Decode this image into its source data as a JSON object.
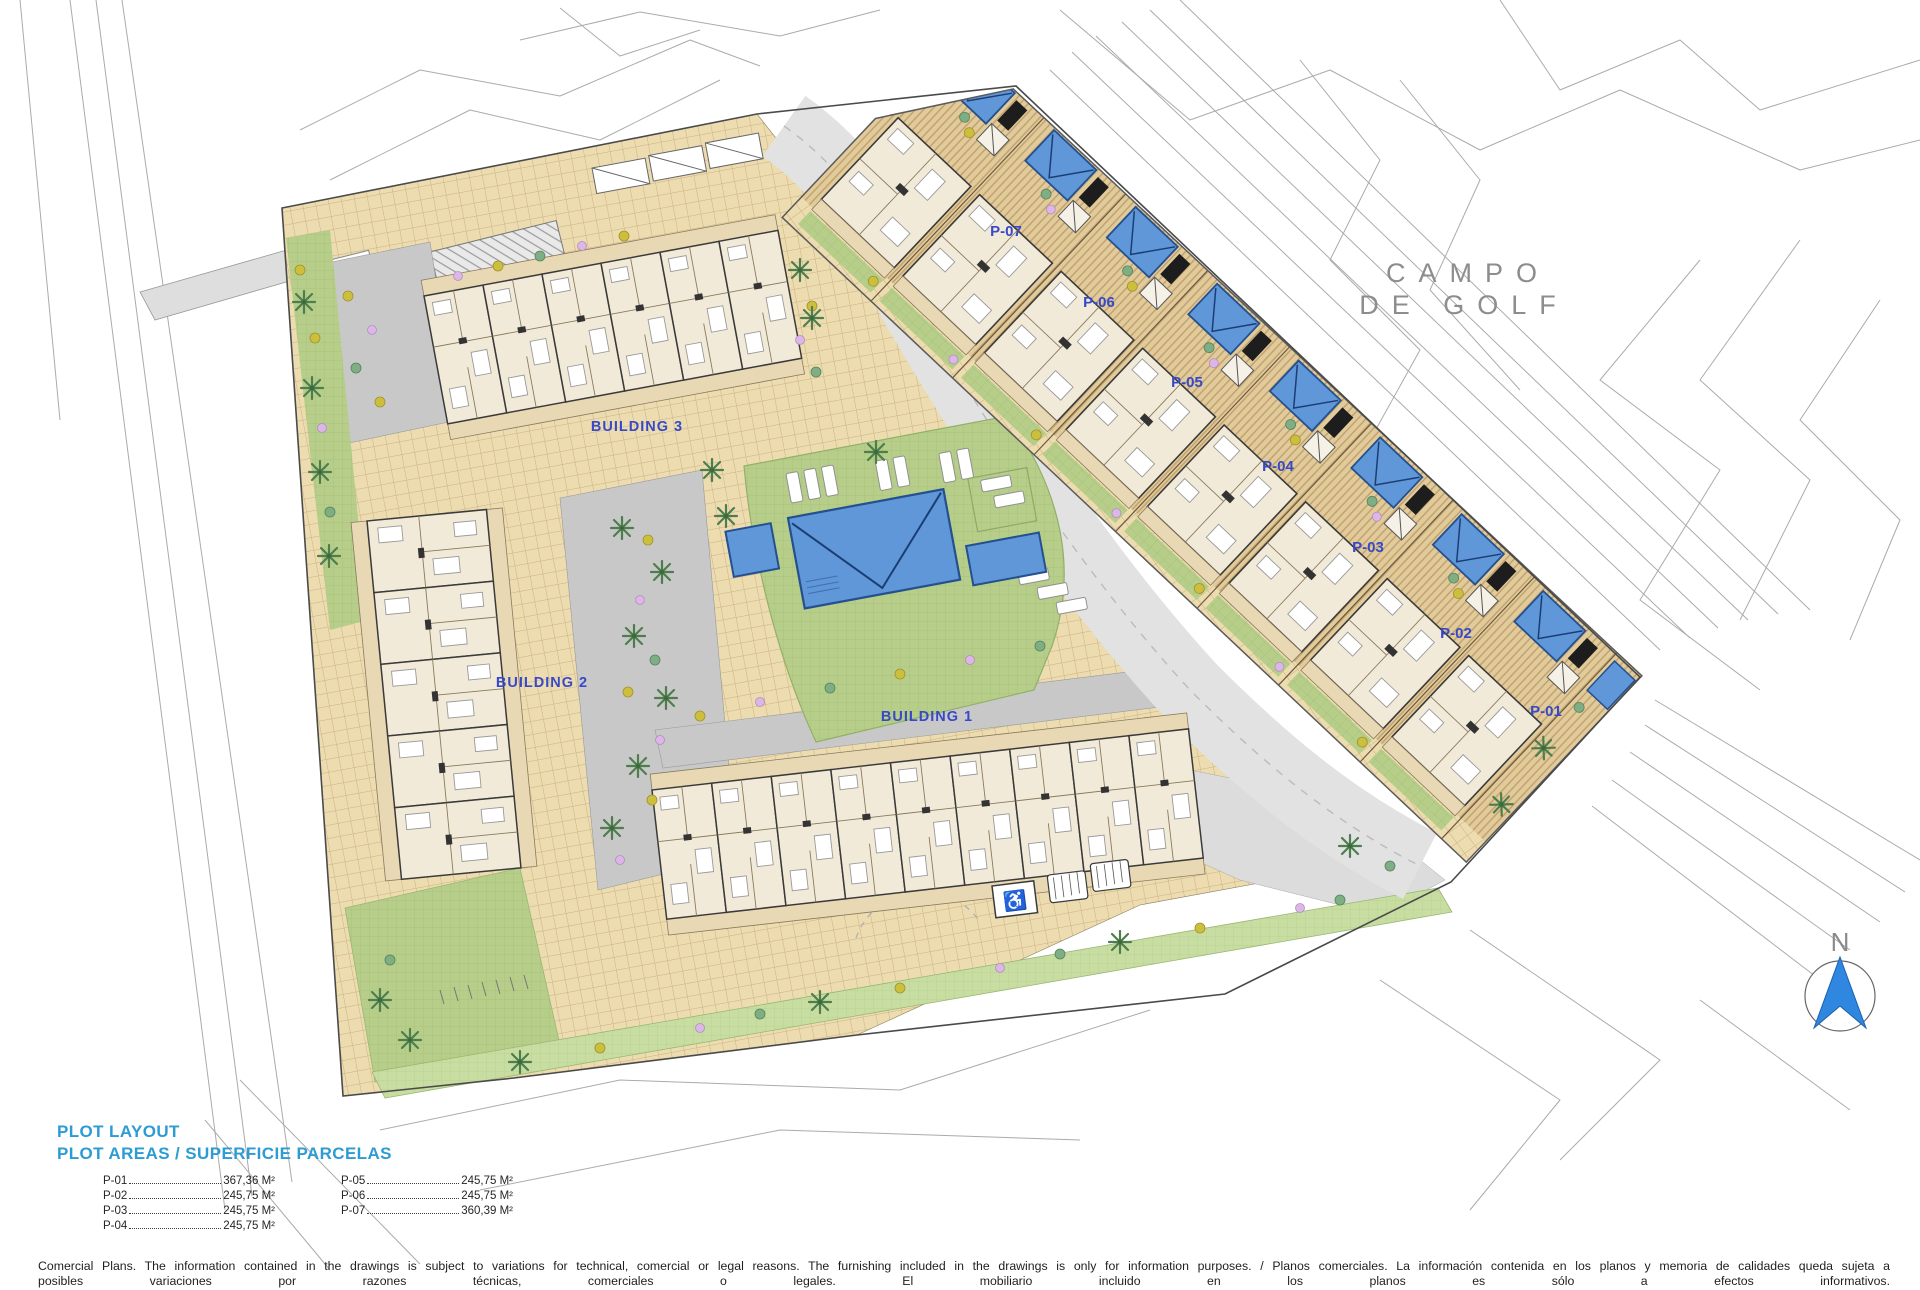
{
  "plan": {
    "area_label": {
      "line1": "CAMPO",
      "line2": "DE GOLF"
    },
    "north": "N",
    "buildings": [
      {
        "label": "BUILDING 1"
      },
      {
        "label": "BUILDING 2"
      },
      {
        "label": "BUILDING 3"
      }
    ],
    "plots": [
      {
        "label": "P-01"
      },
      {
        "label": "P-02"
      },
      {
        "label": "P-03"
      },
      {
        "label": "P-04"
      },
      {
        "label": "P-05"
      },
      {
        "label": "P-06"
      },
      {
        "label": "P-07"
      }
    ],
    "accessible_parking_icon": "♿"
  },
  "legend": {
    "title": "PLOT LAYOUT",
    "subtitle": "PLOT AREAS / SUPERFICIE PARCELAS",
    "columns": [
      [
        {
          "label": "P-01",
          "value": "367,36 M²"
        },
        {
          "label": "P-02",
          "value": "245,75 M²"
        },
        {
          "label": "P-03",
          "value": "245,75 M²"
        },
        {
          "label": "P-04",
          "value": "245,75 M²"
        }
      ],
      [
        {
          "label": "P-05",
          "value": "245,75 M²"
        },
        {
          "label": "P-06",
          "value": "245,75 M²"
        },
        {
          "label": "P-07",
          "value": "360,39 M²"
        }
      ]
    ]
  },
  "footer": {
    "line1": "Comercial Plans. The information contained in the drawings is subject to variations for technical, comercial or legal reasons. The furnishing included in the drawings is only for information purposes. / Planos comerciales. La información contenida en los planos y memoria de calidades queda sujeta a",
    "line2": "posibles variaciones por razones técnicas, comerciales o legales. El mobiliario incluido en los planos es sólo a efectos informativos."
  },
  "colors": {
    "label_blue": "#3849c8",
    "legend_blue": "#2d9bd4",
    "pool_blue": "#5f97d8",
    "tile_tan": "#ecdcb0",
    "lawn_green": "#b6ce89"
  }
}
